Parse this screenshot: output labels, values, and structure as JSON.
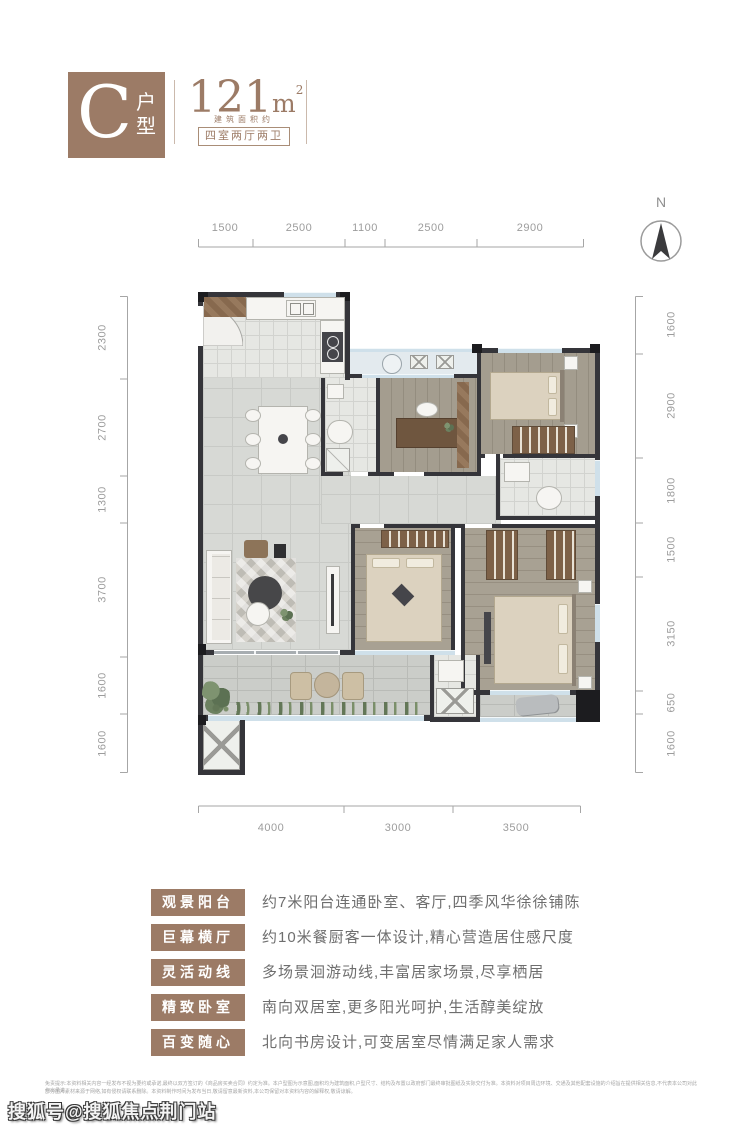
{
  "header": {
    "plan_letter": "C",
    "plan_word_top": "户",
    "plan_word_bottom": "型",
    "area_value": "121",
    "area_unit": "m",
    "area_sup": "2",
    "area_note": "建筑面积约",
    "layout_badge": "四室两厅两卫"
  },
  "compass": {
    "label": "N"
  },
  "dimensions": {
    "top": [
      "1500",
      "2500",
      "1100",
      "2500",
      "2900"
    ],
    "left": [
      "2300",
      "2700",
      "1300",
      "3700",
      "1600",
      "1600"
    ],
    "right": [
      "1600",
      "2900",
      "1800",
      "1500",
      "3150",
      "650",
      "1600"
    ],
    "bottom": [
      "4000",
      "3000",
      "3500"
    ]
  },
  "features": [
    {
      "label": "观景阳台",
      "desc": "约7米阳台连通卧室、客厅,四季风华徐徐铺陈"
    },
    {
      "label": "巨幕横厅",
      "desc": "约10米餐厨客一体设计,精心营造居住感尺度"
    },
    {
      "label": "灵活动线",
      "desc": "多场景洄游动线,丰富居家场景,尽享栖居"
    },
    {
      "label": "精致卧室",
      "desc": "南向双居室,更多阳光呵护,生活醇美绽放"
    },
    {
      "label": "百变随心",
      "desc": "北向书房设计,可变居室尽情满足家人需求"
    }
  ],
  "disclaimer": {
    "line1": "免责提示:本资料相关内容一经发布不视为要约或承诺,最终以双方签订的《商品房买卖合同》约定为准。本户型图为示意图,面积均为建筑面积,户型尺寸、结构及布置以政府部门最终审批图纸及实际交付为准。本资料对项目周边环境、交通及其他配套设施的介绍旨在提供相关信息,不代表本公司对此作出承诺。",
    "line2": "部分图片素材来源于网络,如有侵权请联系删除。本资料制作时间为发布当日,敬请留意最新资料,本公司保留对本资料内容的解释权,敬请谅解。"
  },
  "watermark": "搜狐号@搜狐焦点荆门站",
  "colors": {
    "accent": "#9c7b66",
    "dim_text": "#9c9c9c",
    "wall": "#35353a",
    "window": "#cfe0ea"
  }
}
